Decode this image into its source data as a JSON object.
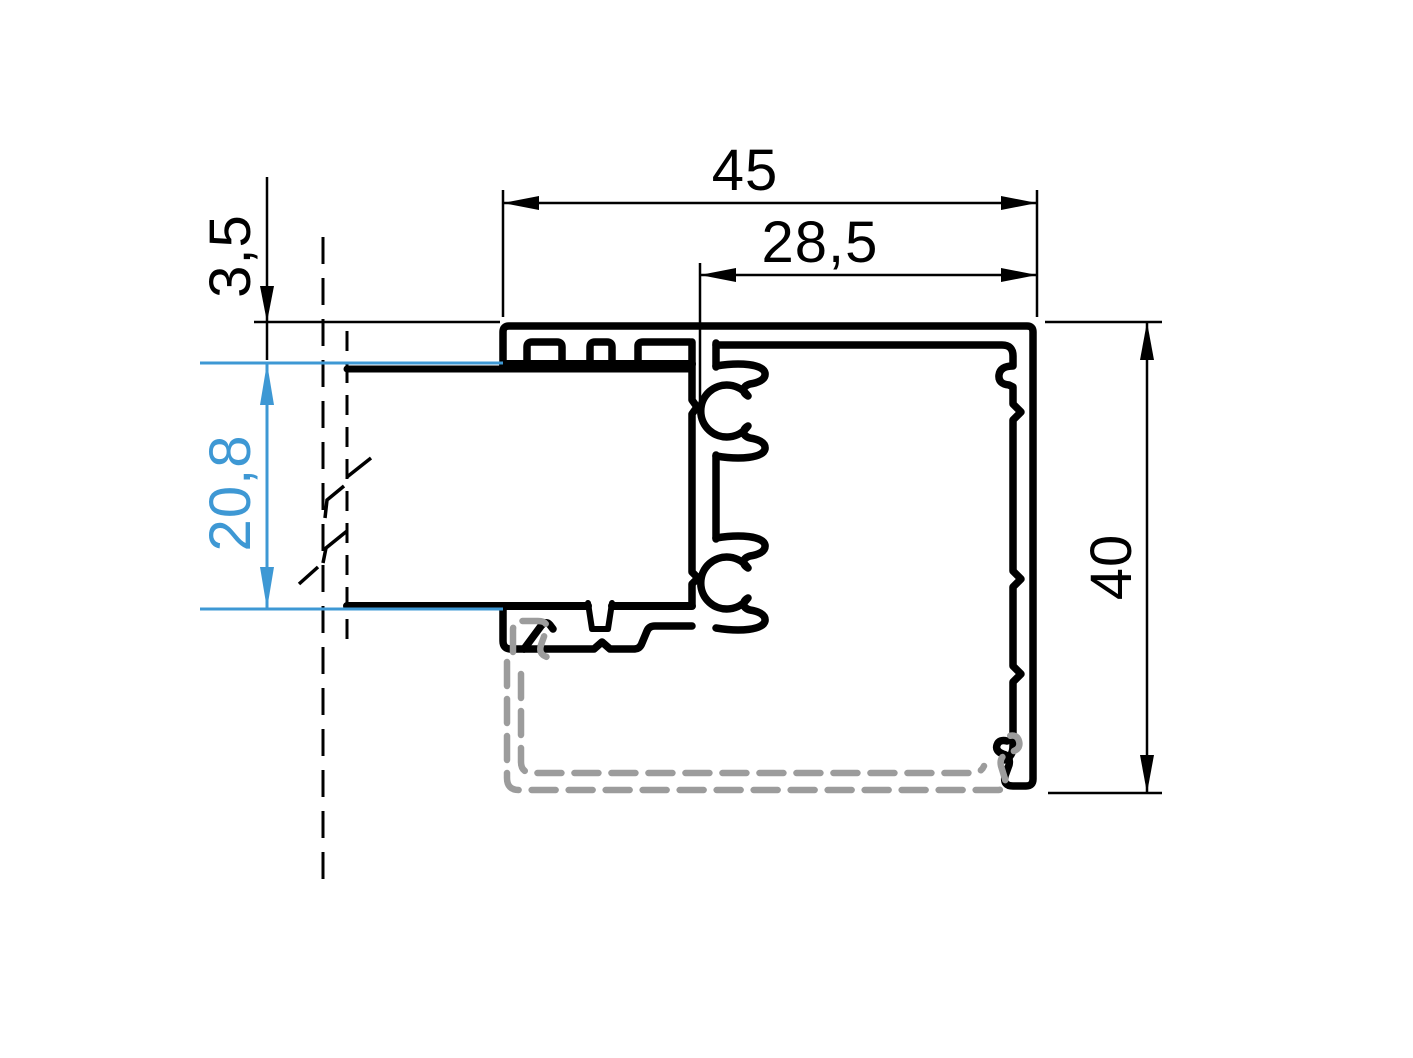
{
  "drawing": {
    "title": "Aluminium frame profile cross-section",
    "unit": "mm",
    "dimensions": {
      "total_width": {
        "label": "45",
        "orientation": "horizontal"
      },
      "inner_width": {
        "label": "28,5",
        "orientation": "horizontal"
      },
      "top_offset": {
        "label": "3,5",
        "orientation": "vertical"
      },
      "glass_pocket": {
        "label": "20,8",
        "orientation": "vertical"
      },
      "total_height": {
        "label": "40",
        "orientation": "vertical"
      }
    },
    "colors": {
      "profile_outline": "#000000",
      "dimension_lines": "#000000",
      "highlight_dimension": "#3e98d4",
      "alternate_bead_profile": "#9c9c9c",
      "background": "#ffffff"
    }
  }
}
